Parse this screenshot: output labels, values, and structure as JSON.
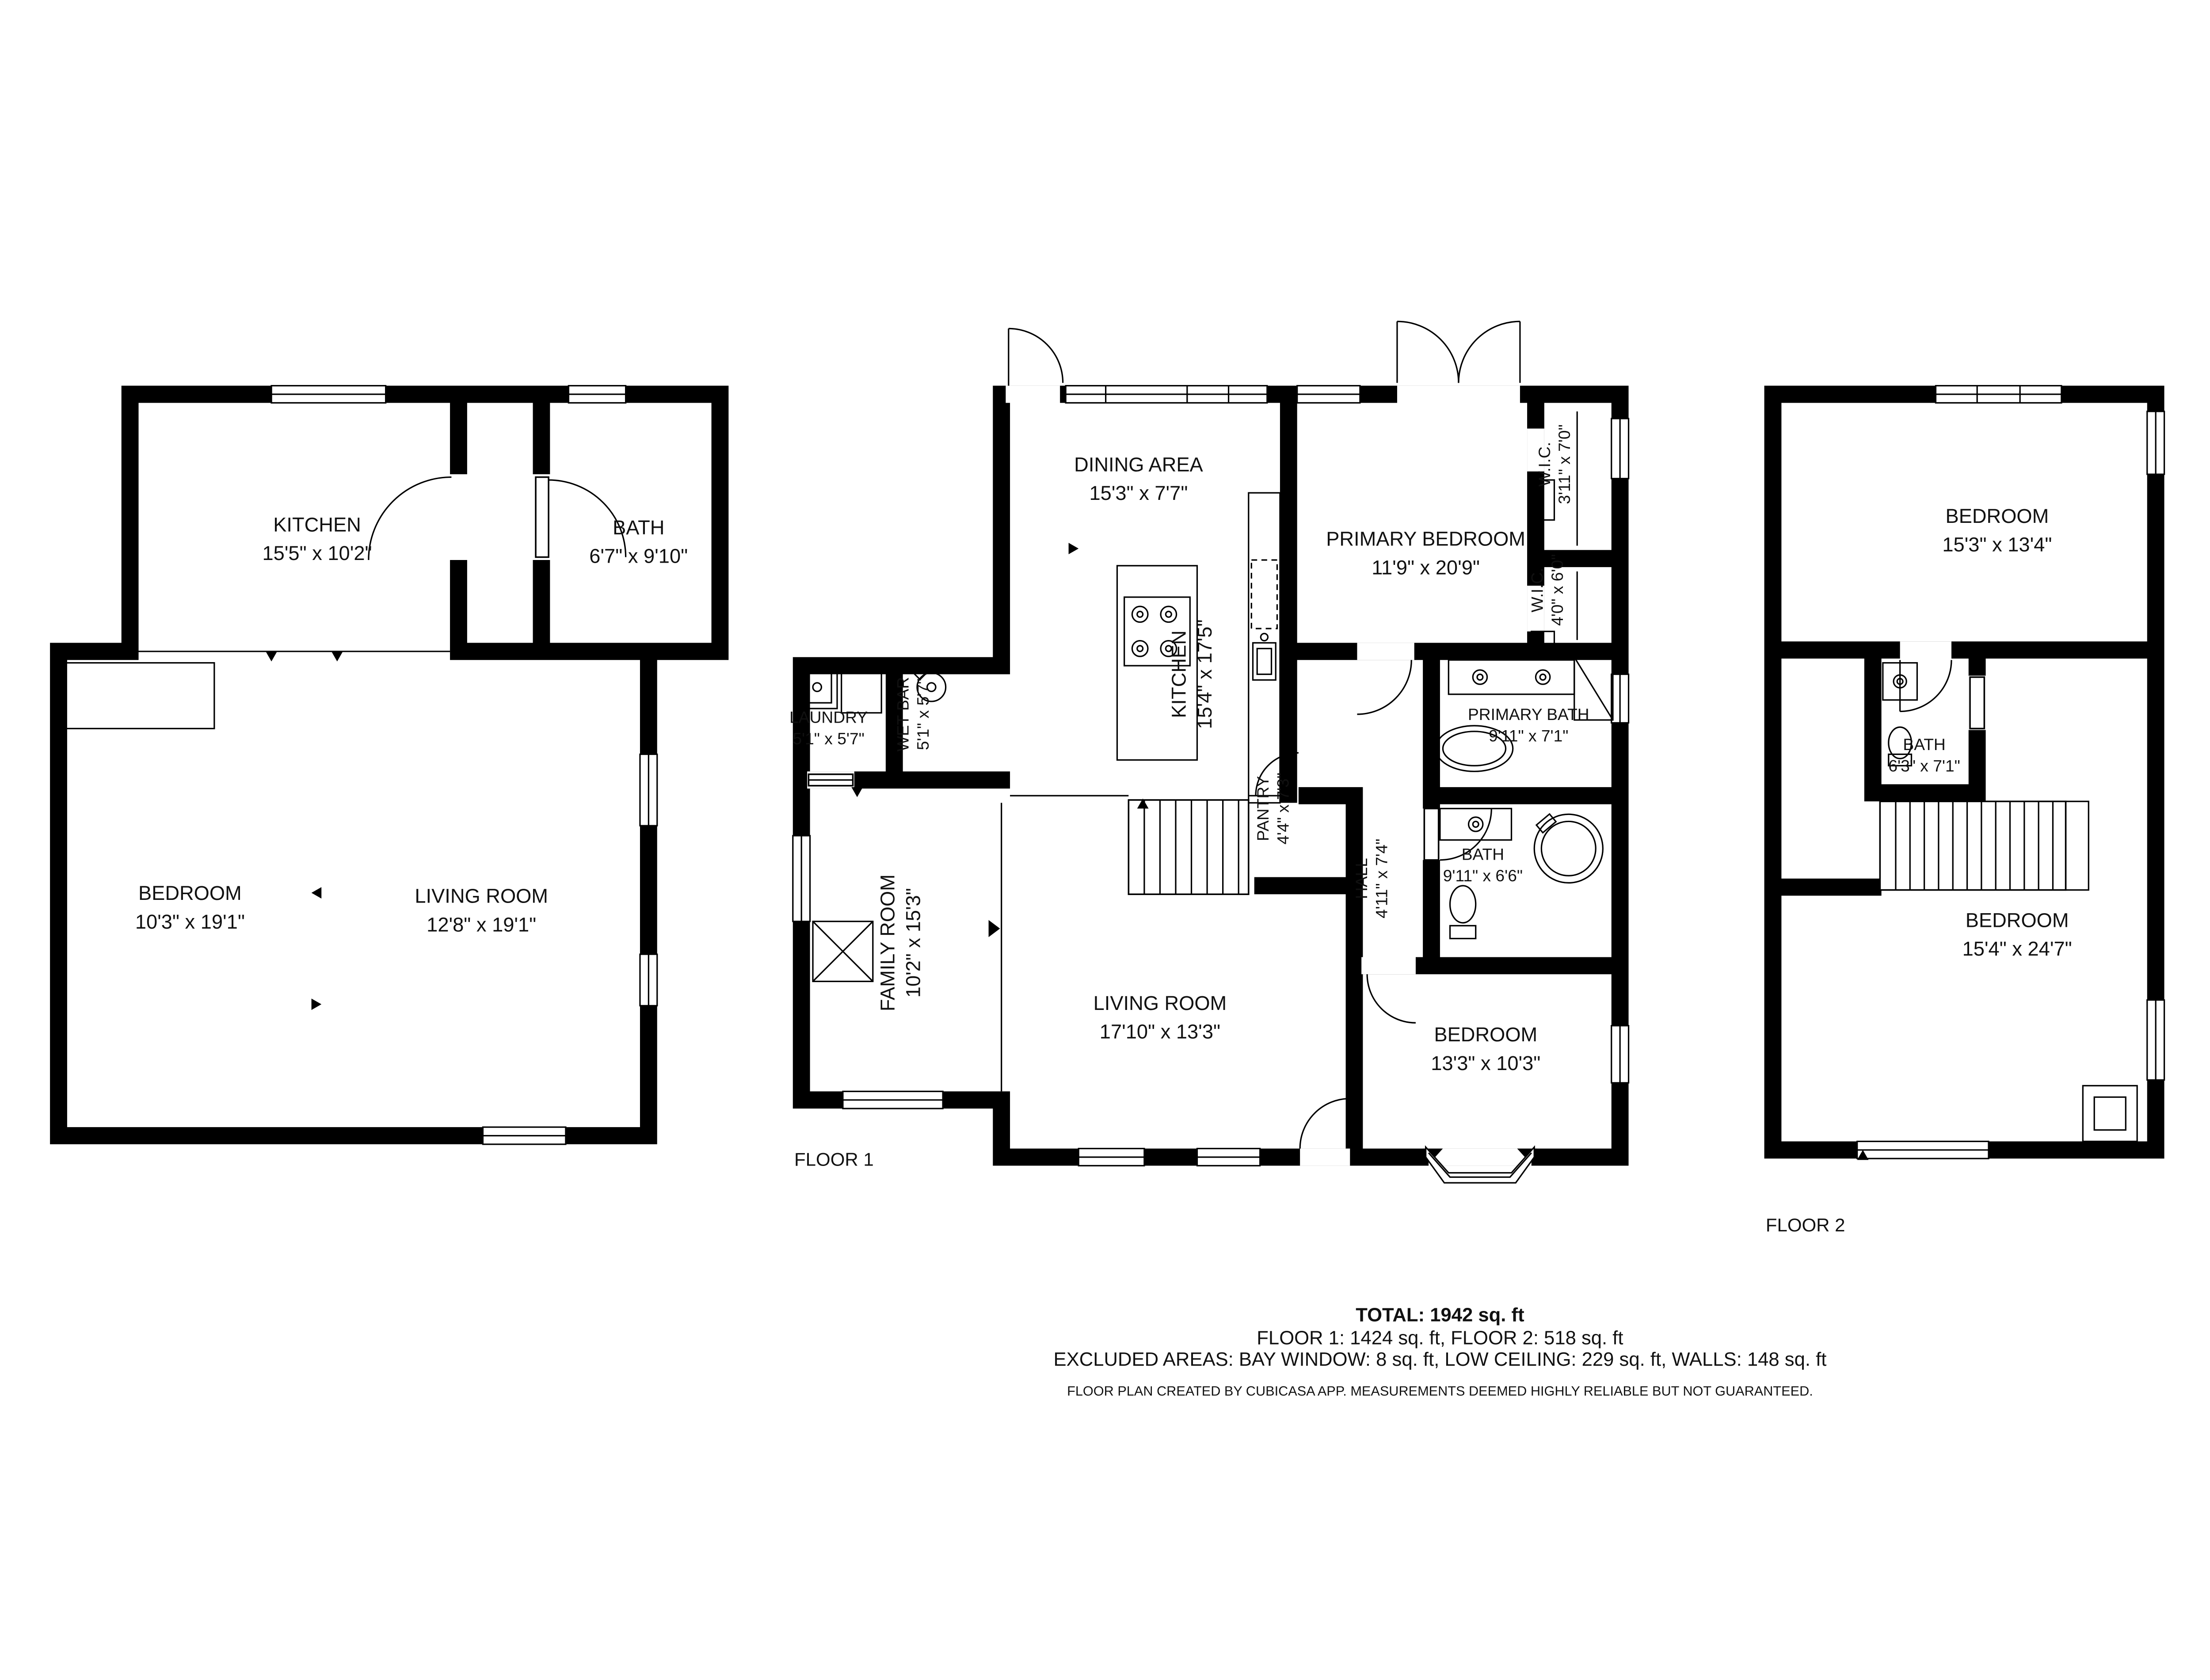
{
  "summary": {
    "total": "TOTAL: 1942 sq. ft",
    "floors": "FLOOR 1: 1424 sq. ft, FLOOR 2: 518 sq. ft",
    "excluded": "EXCLUDED AREAS: BAY WINDOW: 8 sq. ft, LOW CEILING: 229 sq. ft, WALLS: 148 sq. ft",
    "disclaimer": "FLOOR PLAN CREATED BY CUBICASA APP. MEASUREMENTS DEEMED HIGHLY RELIABLE BUT NOT GUARANTEED."
  },
  "floor_labels": {
    "floor1": "FLOOR 1",
    "floor2": "FLOOR 2"
  },
  "plans": {
    "lower": {
      "rooms": [
        {
          "name": "KITCHEN",
          "dims": "15'5\" x 10'2\""
        },
        {
          "name": "BATH",
          "dims": "6'7\" x 9'10\""
        },
        {
          "name": "BEDROOM",
          "dims": "10'3\" x 19'1\""
        },
        {
          "name": "LIVING ROOM",
          "dims": "12'8\" x 19'1\""
        }
      ]
    },
    "floor1": {
      "rooms": [
        {
          "name": "DINING AREA",
          "dims": "15'3\" x 7'7\""
        },
        {
          "name": "PRIMARY BEDROOM",
          "dims": "11'9\" x 20'9\""
        },
        {
          "name": "W.I.C.",
          "dims": "3'11\" x 7'0\""
        },
        {
          "name": "W.I.C.",
          "dims": "4'0\" x 6'0\""
        },
        {
          "name": "KITCHEN",
          "dims": "15'4\" x 17'5\""
        },
        {
          "name": "LAUNDRY",
          "dims": "5'1\" x 5'7\""
        },
        {
          "name": "WET BAR",
          "dims": "5'1\" x 5'7\""
        },
        {
          "name": "PANTRY",
          "dims": "4'4\" x 7'3\""
        },
        {
          "name": "PRIMARY BATH",
          "dims": "9'11\" x 7'1\""
        },
        {
          "name": "HALL",
          "dims": "4'11\" x 7'4\""
        },
        {
          "name": "BATH",
          "dims": "9'11\" x 6'6\""
        },
        {
          "name": "FAMILY ROOM",
          "dims": "10'2\" x 15'3\""
        },
        {
          "name": "LIVING ROOM",
          "dims": "17'10\" x 13'3\""
        },
        {
          "name": "BEDROOM",
          "dims": "13'3\" x 10'3\""
        }
      ]
    },
    "floor2": {
      "rooms": [
        {
          "name": "BEDROOM",
          "dims": "15'3\" x 13'4\""
        },
        {
          "name": "BATH",
          "dims": "6'3\" x 7'1\""
        },
        {
          "name": "BEDROOM",
          "dims": "15'4\" x 24'7\""
        }
      ]
    }
  }
}
